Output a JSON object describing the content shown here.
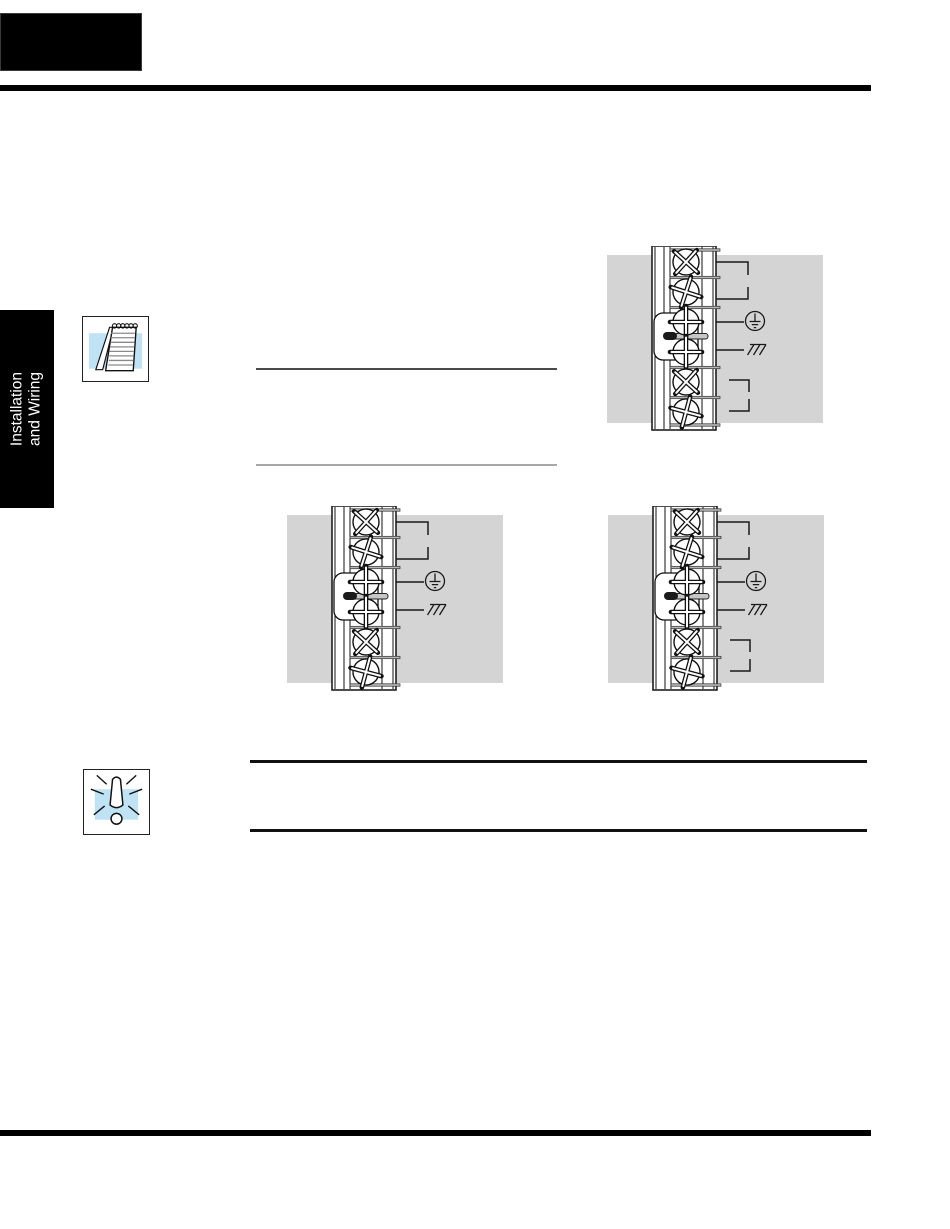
{
  "sidebar_tab": {
    "label_line1": "Installation",
    "label_line2": "and Wiring"
  },
  "icons": {
    "note_icon": "notepad",
    "warning_icon": "exclamation-burst"
  },
  "colors": {
    "panel_gray": "#d4d4d4",
    "icon_blue": "#bfe2f4",
    "ink": "#111111",
    "strip_white": "#ffffff",
    "jumper_bar_gray": "#c6c6c6",
    "separator_gray": "#b5b5b5"
  },
  "diagrams": [
    {
      "name": "power-terminal-block-top-right",
      "terminal_count": 6,
      "jumper_terminals": [
        3,
        4
      ],
      "marks": [
        "bracket-top",
        "bracket-bottom",
        "earth-ground",
        "chassis-ground",
        "float-bracket-top",
        "float-bracket-bottom"
      ]
    },
    {
      "name": "power-terminal-block-middle-left",
      "terminal_count": 6,
      "jumper_terminals": [
        3,
        4
      ],
      "marks": [
        "bracket-top",
        "bracket-bottom",
        "earth-ground",
        "chassis-ground",
        "none",
        "none"
      ]
    },
    {
      "name": "power-terminal-block-middle-right",
      "terminal_count": 6,
      "jumper_terminals": [
        3,
        4
      ],
      "marks": [
        "bracket-top",
        "bracket-bottom",
        "earth-ground",
        "chassis-ground",
        "float-bracket-top",
        "float-bracket-bottom"
      ]
    }
  ]
}
